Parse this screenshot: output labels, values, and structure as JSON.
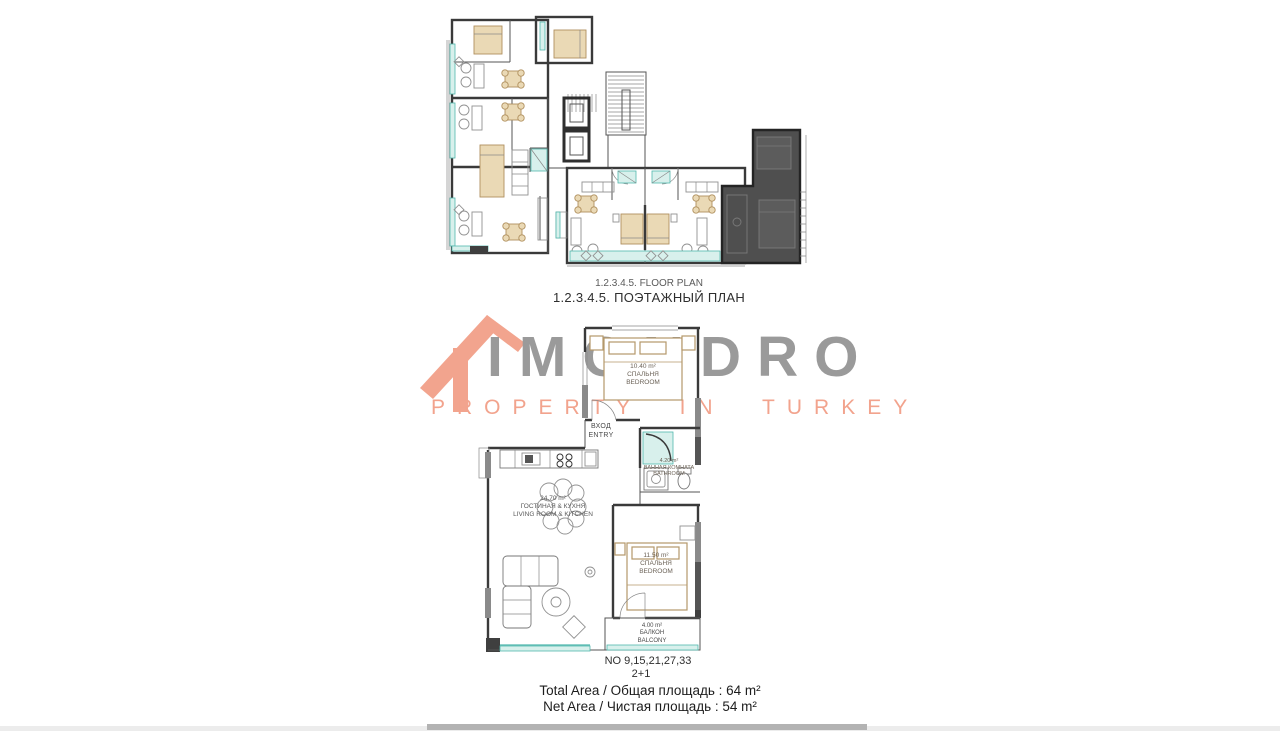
{
  "floor_plan_section": {
    "title_en": "1.2.3.4.5. FLOOR PLAN",
    "title_ru": "1.2.3.4.5. ПОЭТАЖНЫЙ ПЛАН"
  },
  "watermark": {
    "brand": "IMONDRO",
    "tagline": "PROPERTY IN TURKEY",
    "brand_color": "#9a9a9a",
    "accent_color": "#f2a38d"
  },
  "unit_plan": {
    "bedroom1": {
      "area": "10.40 m²",
      "name_ru": "СПАЛЬНЯ",
      "name_en": "BEDROOM"
    },
    "entry": {
      "name_ru": "ВХОД",
      "name_en": "ENTRY"
    },
    "bathroom": {
      "area": "4.20 m²",
      "name_ru": "ВАННАЯ КОМНАТА",
      "name_en": "BATHROOM"
    },
    "living": {
      "area": "24.70 m²",
      "name_ru": "ГОСТИНАЯ & КУХНЯ",
      "name_en": "LIVING ROOM & KITCHEN"
    },
    "bedroom2": {
      "area": "11.50 m²",
      "name_ru": "СПАЛЬНЯ",
      "name_en": "BEDROOM"
    },
    "balcony": {
      "area": "4.00 m²",
      "name_ru": "БАЛКОН",
      "name_en": "BALCONY"
    }
  },
  "summary": {
    "unit_numbers": "NO 9,15,21,27,33",
    "unit_type": "2+1",
    "total_area": "Total Area / Общая площадь : 64 m²",
    "net_area": "Net Area / Чистая площадь : 54 m²"
  },
  "colors": {
    "wall": "#3a3a3a",
    "teal_accent": "#52b8ae",
    "furniture_tan": "#b5986a",
    "highlighted_unit": "#4f4f4f"
  }
}
